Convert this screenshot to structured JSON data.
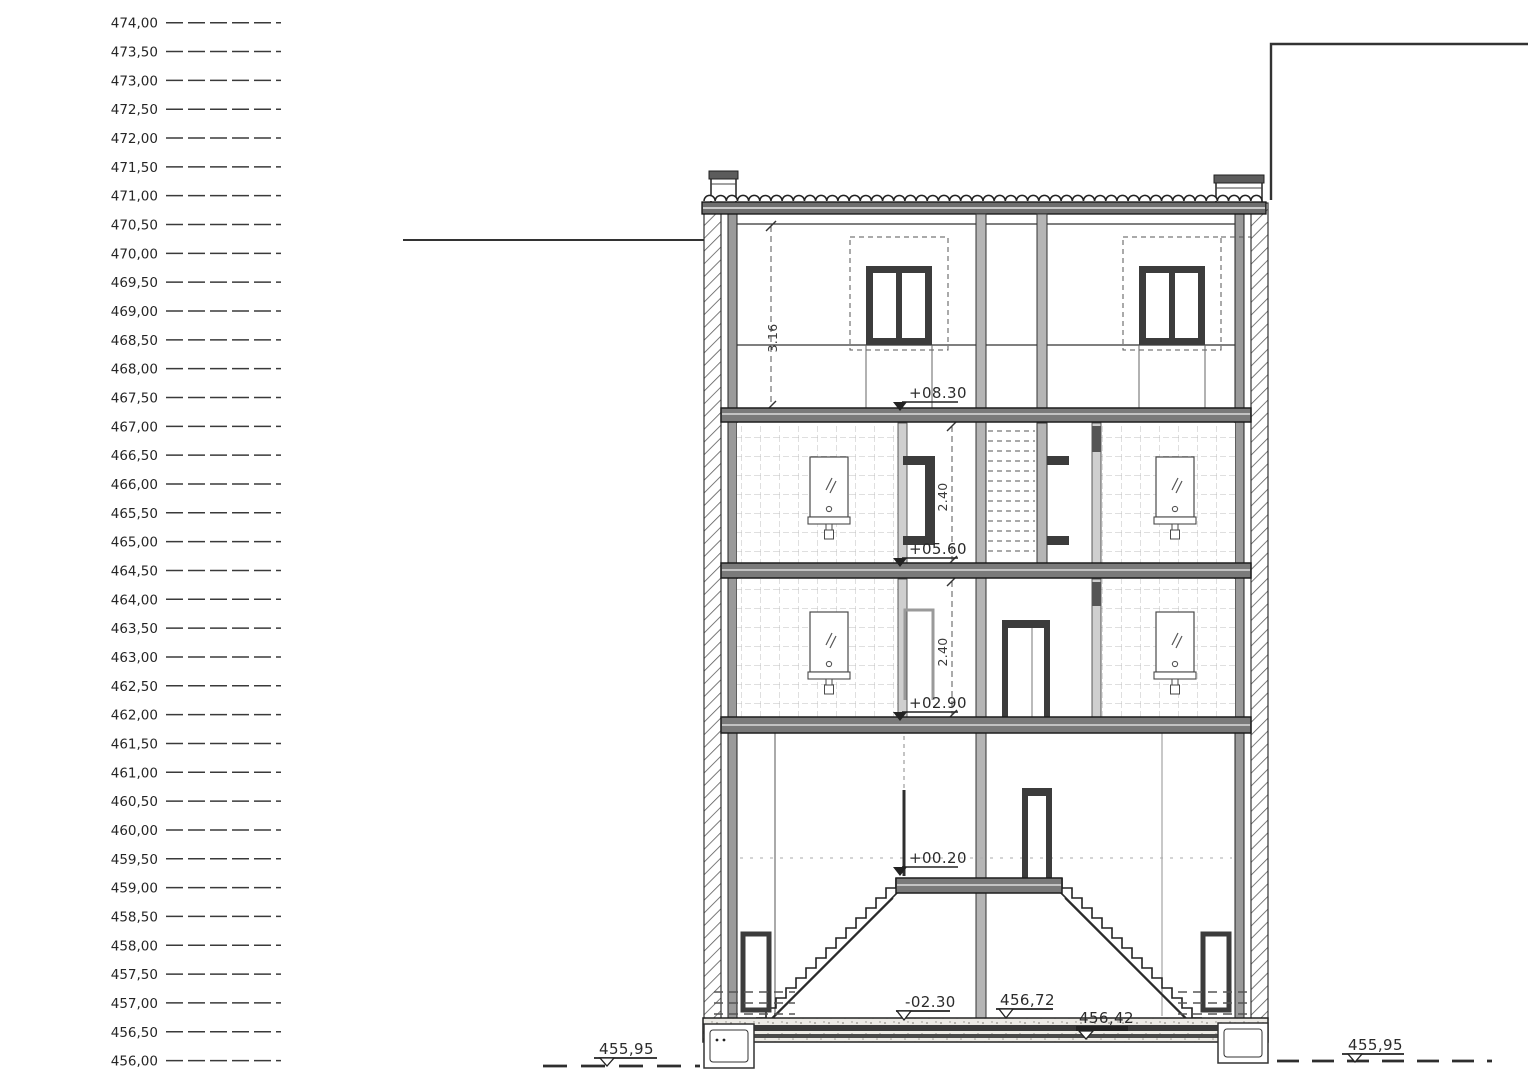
{
  "elevation_scale": {
    "labels": [
      "474,00",
      "473,50",
      "473,00",
      "472,50",
      "472,00",
      "471,50",
      "471,00",
      "470,50",
      "470,00",
      "469,50",
      "469,00",
      "468,50",
      "468,00",
      "467,50",
      "467,00",
      "466,50",
      "466,00",
      "465,50",
      "465,00",
      "464,50",
      "464,00",
      "463,50",
      "463,00",
      "462,50",
      "462,00",
      "461,50",
      "461,00",
      "460,50",
      "460,00",
      "459,50",
      "459,00",
      "458,50",
      "458,00",
      "457,50",
      "457,00",
      "456,50",
      "456,00"
    ]
  },
  "section": {
    "level_marks": [
      {
        "id": "attic-floor",
        "label": "+08.30"
      },
      {
        "id": "second-floor",
        "label": "+05.60"
      },
      {
        "id": "first-floor",
        "label": "+02.90"
      },
      {
        "id": "entry-landing",
        "label": "+00.20"
      },
      {
        "id": "basement-floor",
        "label": "-02.30"
      },
      {
        "id": "basement-absolute",
        "label": "456,72"
      },
      {
        "id": "foundation-absolute",
        "label": "456,42"
      },
      {
        "id": "grade-left",
        "label": "455,95"
      },
      {
        "id": "grade-right",
        "label": "455,95"
      }
    ],
    "dimensions": [
      {
        "id": "attic-clear-height",
        "label": "3.16"
      },
      {
        "id": "upper-floor-clear-height",
        "label": "2.40"
      },
      {
        "id": "lower-floor-clear-height",
        "label": "2.40"
      }
    ],
    "line_color": "#2b2b2b",
    "slab_color": "#7a7a7a",
    "wall_fill": "#b5b5b5"
  }
}
